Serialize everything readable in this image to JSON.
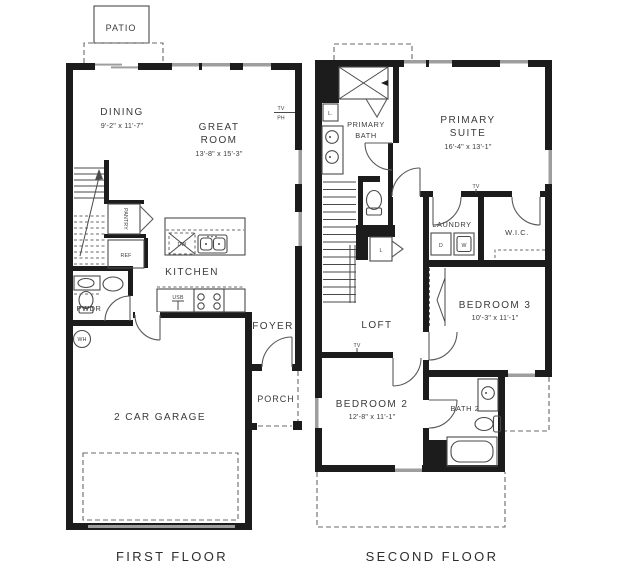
{
  "captions": {
    "first": "FIRST FLOOR",
    "second": "SECOND FLOOR"
  },
  "first_floor": {
    "patio": "PATIO",
    "dining": "DINING",
    "dining_dims": "9'-2\" x 11'-7\"",
    "great_room_1": "GREAT",
    "great_room_2": "ROOM",
    "great_room_dims": "13'-8\" x 15'-3\"",
    "tv": "TV",
    "ph": "PH",
    "pantry": "PANTRY",
    "ref": "REF",
    "dw": "DW",
    "kitchen": "KITCHEN",
    "usb": "USB",
    "pwdr": "PWDR",
    "wh": "WH",
    "foyer": "FOYER",
    "porch": "PORCH",
    "garage": "2 CAR GARAGE"
  },
  "second_floor": {
    "primary_bath_1": "PRIMARY",
    "primary_bath_2": "BATH",
    "primary_suite_1": "PRIMARY",
    "primary_suite_2": "SUITE",
    "primary_suite_dims": "16'-4\" x 13'-1\"",
    "linen_upper": "L.",
    "linen_lower": "L",
    "laundry": "LAUNDRY",
    "dryer": "D",
    "washer": "W",
    "wic": "W.I.C.",
    "bedroom3": "BEDROOM 3",
    "bedroom3_dims": "10'-3\" x 11'-1\"",
    "loft": "LOFT",
    "tv": "TV",
    "bedroom2": "BEDROOM 2",
    "bedroom2_dims": "12'-8\" x 11'-1\"",
    "bath2": "BATH 2"
  },
  "colors": {
    "wall": "#1c1c1c",
    "window": "#9e9e9e",
    "fixture_line": "#4a4a4a",
    "text": "#3b3b3b",
    "background": "#ffffff"
  }
}
